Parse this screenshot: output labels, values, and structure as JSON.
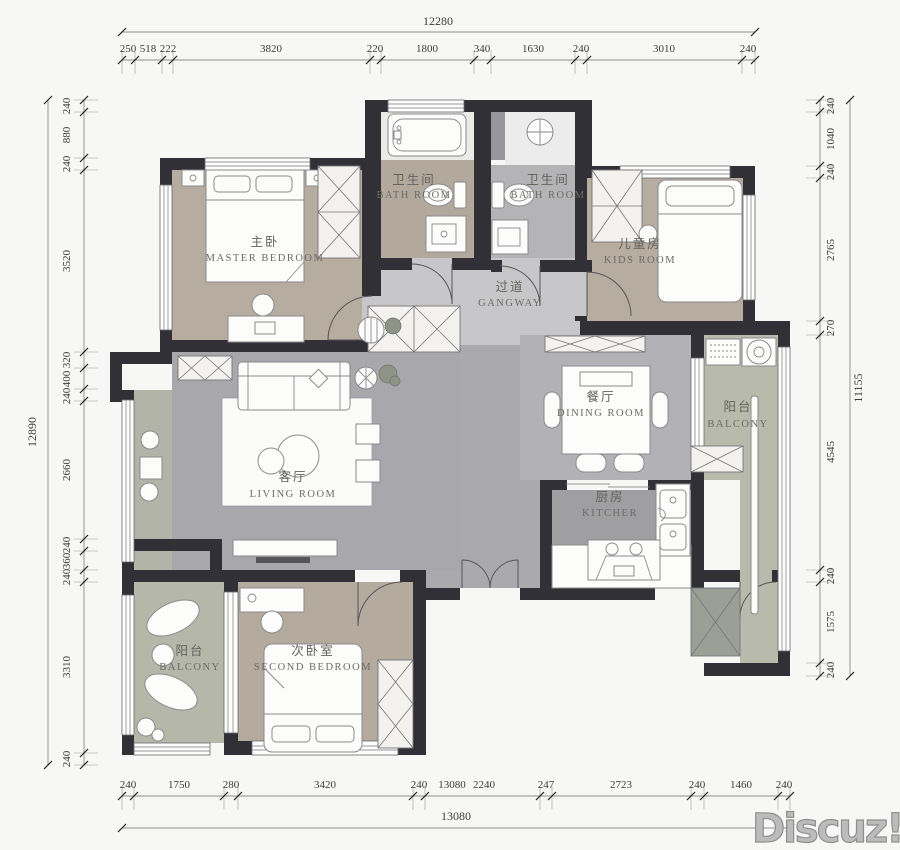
{
  "rooms": {
    "master_bedroom": {
      "name_cn": "主卧",
      "name_en": "MASTER BEDROOM"
    },
    "bathroom_1": {
      "name_cn": "卫生间",
      "name_en": "BATH ROOM"
    },
    "bathroom_2": {
      "name_cn": "卫生间",
      "name_en": "BATH ROOM"
    },
    "kids_room": {
      "name_cn": "儿童房",
      "name_en": "KIDS ROOM"
    },
    "gangway": {
      "name_cn": "过道",
      "name_en": "GANGWAY"
    },
    "dining_room": {
      "name_cn": "餐厅",
      "name_en": "DINING ROOM"
    },
    "balcony_east": {
      "name_cn": "阳台",
      "name_en": "BALCONY"
    },
    "living_room": {
      "name_cn": "客厅",
      "name_en": "LIVING ROOM"
    },
    "kitchen": {
      "name_cn": "厨房",
      "name_en": "KITCHER"
    },
    "balcony_south": {
      "name_cn": "阳台",
      "name_en": "BALCONY"
    },
    "second_bedroom": {
      "name_cn": "次卧室",
      "name_en": "SECOND BEDROOM"
    }
  },
  "dimensions": {
    "top": {
      "total": "12280",
      "segments": [
        "250",
        "518",
        "222",
        "3820",
        "220",
        "1800",
        "340",
        "1630",
        "240",
        "3010",
        "240"
      ]
    },
    "bottom": {
      "total": "13080",
      "extra_overlap_label": "13080",
      "segments": [
        "240",
        "1750",
        "280",
        "3420",
        "240",
        "2240",
        "247",
        "2723",
        "240",
        "1460",
        "240"
      ]
    },
    "left": {
      "total": "12890",
      "segments": [
        "240",
        "880",
        "240",
        "3520",
        "320",
        "400",
        "240",
        "2660",
        "240",
        "360",
        "240",
        "3310",
        "240"
      ]
    },
    "right": {
      "total": "11155",
      "segments": [
        "240",
        "1040",
        "240",
        "2765",
        "270",
        "4545",
        "240",
        "1575",
        "240"
      ]
    }
  },
  "watermark": "Discuz!",
  "colors": {
    "wall": "#303036",
    "floor_bedroom": "#b7aca0",
    "floor_living": "#a8a8ac",
    "floor_dining": "#b2b2b6",
    "floor_kitchen": "#9f9fa2",
    "floor_gangway": "#c7c7c9",
    "floor_balcony": "#b8baab",
    "floor_bath_tan": "#b2a89c",
    "floor_bath_gray": "#b4b4b6",
    "paper": "#f7f7f5",
    "dim_text": "#3b3b3b",
    "label_text": "#64625c",
    "watermark_gray": "#bcbcbc"
  }
}
